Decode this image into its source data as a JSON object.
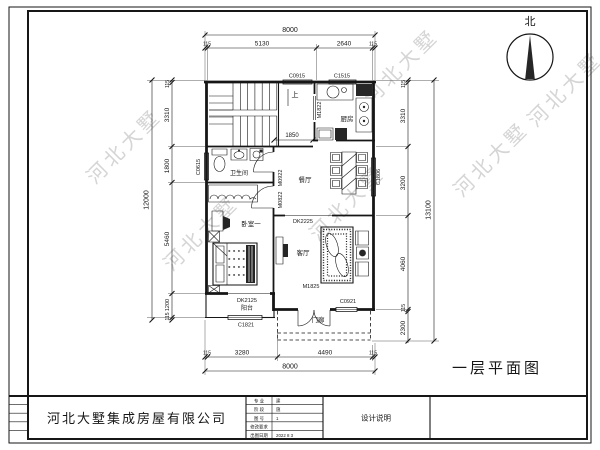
{
  "sheet": {
    "company_name": "河北大墅集成房屋有限公司",
    "drawing_title": "一层平面图",
    "north_label": "北",
    "watermark_text": "河北大墅",
    "title_block": {
      "design_note_label": "设计说明",
      "rows": [
        {
          "label": "专 业",
          "value": "建"
        },
        {
          "label": "阶 段",
          "value": "施"
        },
        {
          "label": "图 号",
          "value": "1"
        },
        {
          "label": "修改要求",
          "value": ""
        },
        {
          "label": "出图日期",
          "value": "2022 8 3"
        }
      ]
    }
  },
  "plan": {
    "rooms": {
      "kitchen": "厨房",
      "dining": "餐厅",
      "living": "客厅",
      "bedroom1": "卧室一",
      "bathroom": "卫生间",
      "balcony": "阳台",
      "porch": "门廊"
    },
    "stair_up_label": "上",
    "inner_dim": "1850",
    "doors": {
      "kitchen": "M1822",
      "bedroom": "M0922",
      "bathroom": "M0822",
      "entry": "M1825"
    },
    "windows": {
      "top_left": "C0915",
      "top_right": "C1515",
      "left": "C0615",
      "right": "C1806",
      "balcony": "C1821",
      "entry": "C0921"
    },
    "openings": {
      "living_dining": "DK2225",
      "balcony": "DK2125"
    },
    "dims": {
      "top": {
        "overall": "8000",
        "segments": [
          "115",
          "5130",
          "2640",
          "115"
        ]
      },
      "bottom": {
        "overall": "8000",
        "segments": [
          "115",
          "3280",
          "4490",
          "115"
        ]
      },
      "left": {
        "overall": "12000",
        "segments": [
          "115",
          "3310",
          "1800",
          "5460",
          "1200",
          "115"
        ]
      },
      "right": {
        "overall": "13100",
        "segments": [
          "115",
          "3310",
          "3200",
          "4060",
          "115",
          "2300"
        ]
      }
    }
  }
}
